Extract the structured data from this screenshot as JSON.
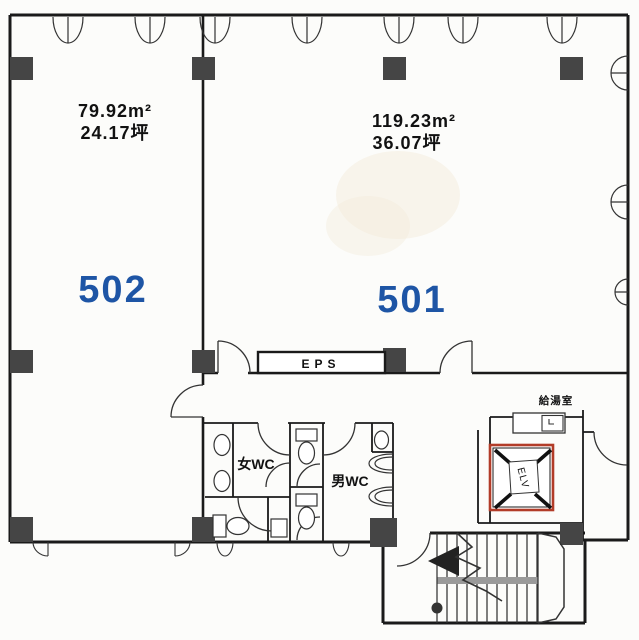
{
  "floorplan": {
    "units": [
      {
        "number": "502",
        "area_m2": "79.92m²",
        "area_tsubo": "24.17坪"
      },
      {
        "number": "501",
        "area_m2": "119.23m²",
        "area_tsubo": "36.07坪"
      }
    ],
    "labels": {
      "eps": "EPS",
      "women_wc": "女WC",
      "men_wc": "男WC",
      "kitchenette": "給湯室",
      "elevator": "ELV"
    },
    "colors": {
      "wall": "#1a1a1a",
      "pillar": "#454545",
      "unit_number_blue": "#1e55a5",
      "elevator_shaft_red": "#b23c28",
      "stair_rail_gray": "#9a9a9a",
      "paper": "#fcfcfa"
    }
  }
}
